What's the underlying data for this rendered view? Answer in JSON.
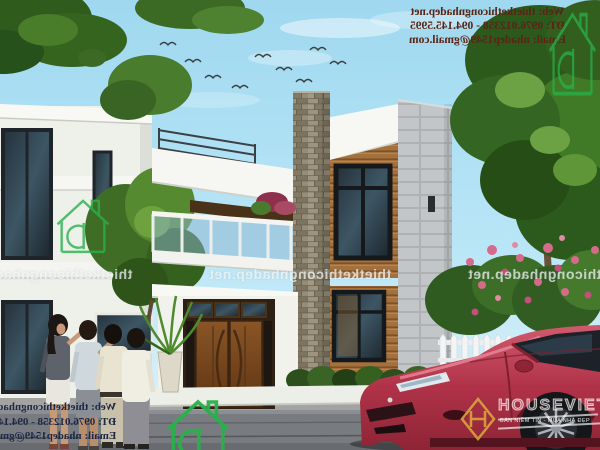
{
  "watermark": {
    "site": "thietkethicongnhadep.net",
    "contact": {
      "web": "Web: thietkethicongnhadep.net",
      "phone": "ĐT: 0976.012358 - 094.145.5995",
      "email": "Email: nhadep1549@gmail.com"
    },
    "band_repeats": 3,
    "mirrored": true,
    "colors": {
      "top_text": "#5a2415",
      "bottom_text": "#1c2747",
      "band_text": "#f5f9fb",
      "logo_green": "#27b24b"
    }
  },
  "branding": {
    "houseviet": {
      "name": "HOUSEVIET",
      "tagline": "BÁN NIỀM TIN - MUA NHÀ ĐẸP",
      "emblem": "H-monogram-diamond",
      "gold": "#d9a43c"
    }
  },
  "icons": {
    "green_house_logo": "house-outline-with-chimney-and-D",
    "houseviet_emblem": "gold-diamond-H-monogram"
  },
  "palette": {
    "sky": "#a5dcf2",
    "house_white": "#f2f3ee",
    "stacked_stone": "#8d8572",
    "wood_slats": "#a4713d",
    "gray_block_wall": "#c2c6c8",
    "door_wood": "#7a4a24",
    "foliage": "#3c6a24",
    "flower_pink": "#d66a8a",
    "pavement": "#75787c",
    "car_red": "#b03248"
  }
}
